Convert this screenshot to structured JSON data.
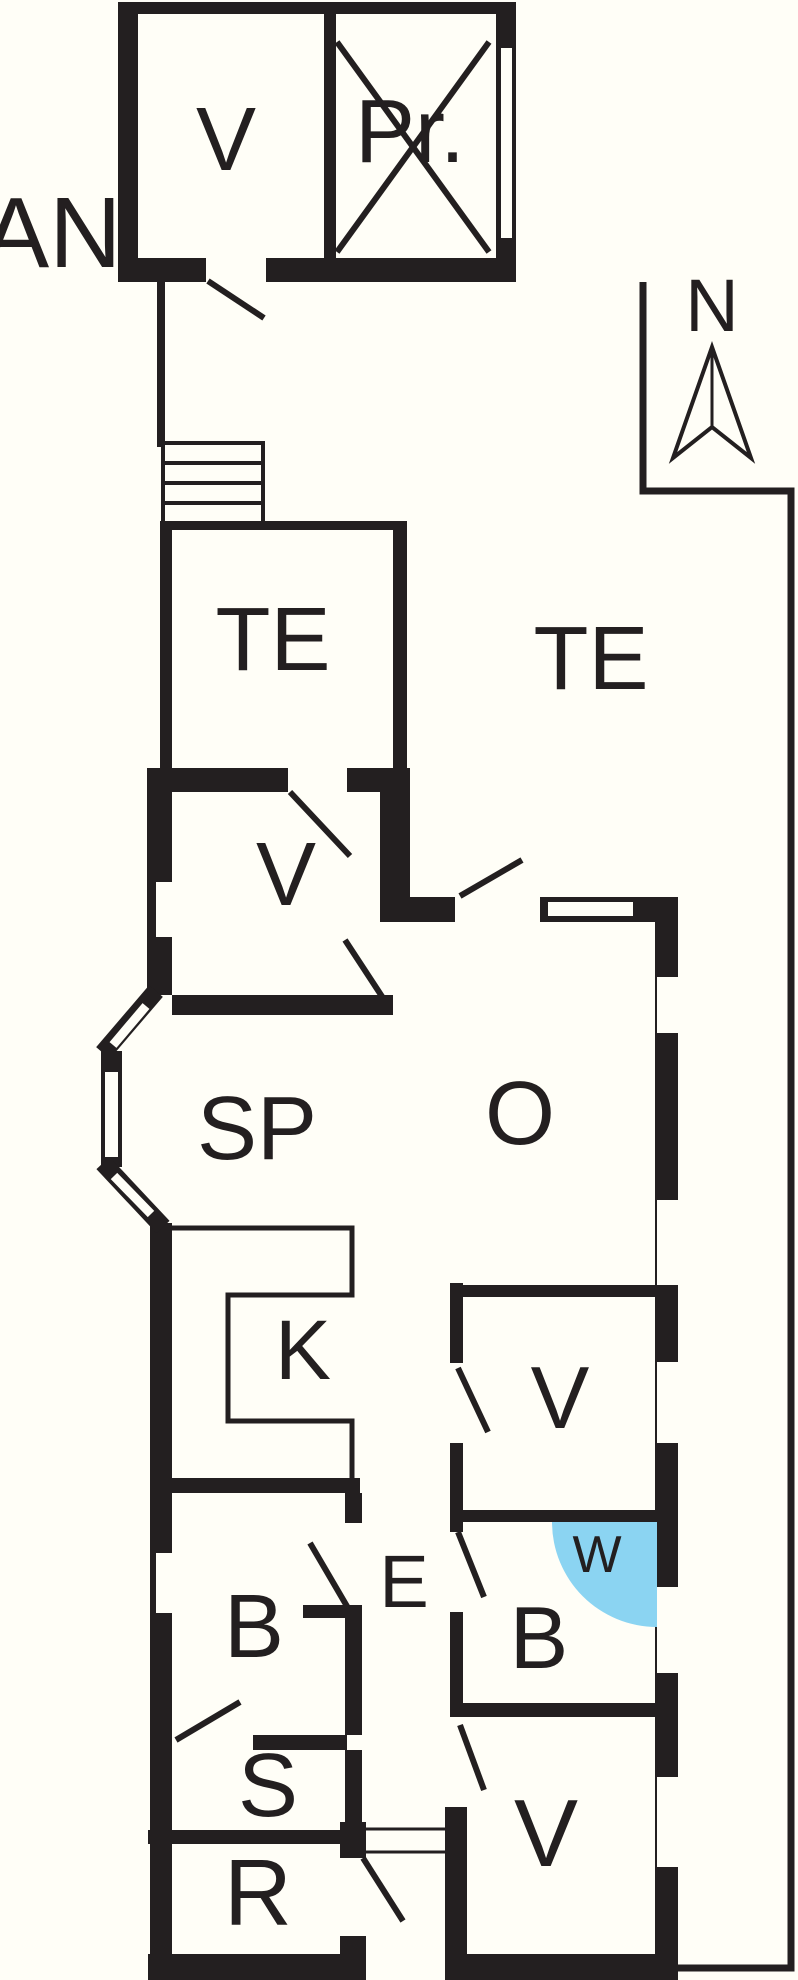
{
  "colors": {
    "wall": "#231f20",
    "water": "#8bd4f2",
    "paper": "#fffef7"
  },
  "compass": {
    "label": "N"
  },
  "annex": {
    "label": "AN",
    "rooms": {
      "v": "V",
      "pr": "Pr."
    }
  },
  "terraces": {
    "small": "TE",
    "large": "TE"
  },
  "rooms": {
    "hall": "V",
    "living": "SP",
    "lounge": "O",
    "kitchen": "K",
    "bedroom_mid": "V",
    "shower": "W",
    "corridor": "E",
    "bath_left": "B",
    "bath_right": "B",
    "sauna": "S",
    "utility": "R",
    "bedroom_bottom": "V"
  }
}
